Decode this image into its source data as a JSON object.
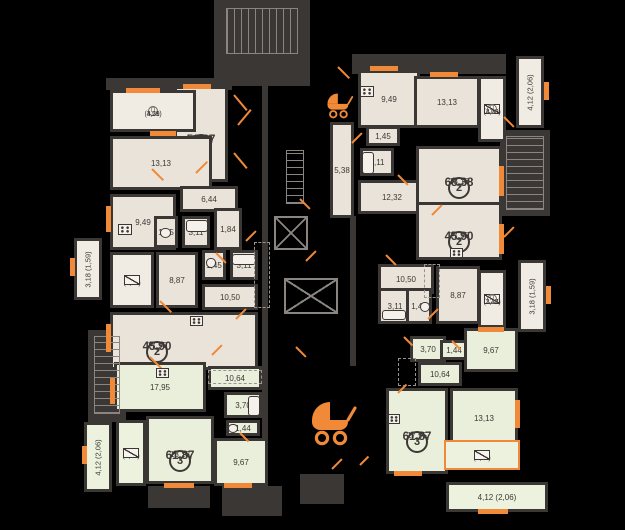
{
  "plan": {
    "colors": {
      "background": "#000000",
      "wall": "#3b3734",
      "room_beige": "#eae3da",
      "room_green": "#e9efda",
      "label_box": "#f0ebe3",
      "accent_orange": "#f08a38",
      "text": "#3c3835",
      "outline_gray": "#8a8580"
    },
    "p_mark": "П",
    "apartment_rooms": [
      {
        "name": "room-living-tl",
        "badge": "2",
        "total": "52,87",
        "area": "14,20",
        "x": 174,
        "y": 86,
        "w": 54,
        "h": 96,
        "fill": "beige"
      },
      {
        "name": "room-bedroom-tl",
        "area": "13,13",
        "x": 110,
        "y": 136,
        "w": 102,
        "h": 54,
        "fill": "beige"
      },
      {
        "name": "room-kitchen-tl",
        "area": "9,49",
        "x": 110,
        "y": 194,
        "w": 66,
        "h": 56,
        "fill": "beige"
      },
      {
        "name": "room-hall-tl",
        "area": "6,44",
        "x": 180,
        "y": 186,
        "w": 58,
        "h": 26,
        "fill": "beige"
      },
      {
        "name": "room-wc-tl",
        "area": "1,45",
        "x": 154,
        "y": 216,
        "w": 24,
        "h": 32,
        "fill": "beige"
      },
      {
        "name": "room-bath-tl",
        "area": "3,11",
        "x": 182,
        "y": 216,
        "w": 28,
        "h": 32,
        "fill": "beige"
      },
      {
        "name": "room-hall2-tl",
        "area": "1,84",
        "x": 214,
        "y": 208,
        "w": 28,
        "h": 42,
        "fill": "beige"
      },
      {
        "name": "room-hall-ml",
        "area": "8,87",
        "x": 156,
        "y": 252,
        "w": 42,
        "h": 56,
        "fill": "beige"
      },
      {
        "name": "room-wc-ml",
        "area": "1,45",
        "x": 202,
        "y": 250,
        "w": 24,
        "h": 30,
        "fill": "beige"
      },
      {
        "name": "room-bath-ml",
        "area": "3,11",
        "x": 230,
        "y": 250,
        "w": 28,
        "h": 30,
        "fill": "beige"
      },
      {
        "name": "room-corridor-ml",
        "area": "10,50",
        "x": 202,
        "y": 284,
        "w": 56,
        "h": 26,
        "fill": "beige"
      },
      {
        "name": "room-living-ml",
        "badge": "2",
        "total": "45,90",
        "area": "17,95",
        "x": 110,
        "y": 312,
        "w": 148,
        "h": 58,
        "fill": "beige",
        "tx": 154,
        "ty": 338
      },
      {
        "name": "room-kitchen-bl",
        "area": "17,95",
        "x": 114,
        "y": 362,
        "w": 92,
        "h": 50,
        "fill": "green"
      },
      {
        "name": "room-corridor-bl",
        "area": "10,64",
        "x": 208,
        "y": 366,
        "w": 54,
        "h": 24,
        "fill": "green"
      },
      {
        "name": "room-bath-bl",
        "area": "3,70",
        "x": 224,
        "y": 392,
        "w": 38,
        "h": 26,
        "fill": "green"
      },
      {
        "name": "room-wc-bl",
        "area": "1,44",
        "x": 226,
        "y": 420,
        "w": 34,
        "h": 16,
        "fill": "green"
      },
      {
        "name": "room-living-bl",
        "badge": "3",
        "total": "61,87",
        "area": "13,13",
        "x": 146,
        "y": 416,
        "w": 68,
        "h": 68,
        "fill": "green"
      },
      {
        "name": "room-bedroom-bl",
        "area": "9,67",
        "x": 214,
        "y": 438,
        "w": 54,
        "h": 48,
        "fill": "green"
      },
      {
        "name": "room-kitchen-tr",
        "area": "9,49",
        "x": 358,
        "y": 70,
        "w": 62,
        "h": 58,
        "fill": "beige"
      },
      {
        "name": "room-bedroom-tr",
        "area": "13,13",
        "x": 414,
        "y": 76,
        "w": 66,
        "h": 52,
        "fill": "beige"
      },
      {
        "name": "room-wc-tr",
        "area": "1,45",
        "x": 366,
        "y": 126,
        "w": 34,
        "h": 20,
        "fill": "beige"
      },
      {
        "name": "room-bath-tr",
        "area": "3,11",
        "x": 360,
        "y": 148,
        "w": 34,
        "h": 28,
        "fill": "beige"
      },
      {
        "name": "room-corridor-tr",
        "area": "5,38",
        "x": 330,
        "y": 122,
        "w": 24,
        "h": 96,
        "fill": "beige"
      },
      {
        "name": "room-hall-tr",
        "area": "12,32",
        "x": 358,
        "y": 180,
        "w": 68,
        "h": 34,
        "fill": "beige"
      },
      {
        "name": "room-living-tr",
        "badge": "2",
        "total": "68,38",
        "area": "18,16",
        "x": 416,
        "y": 146,
        "w": 86,
        "h": 62,
        "fill": "beige"
      },
      {
        "name": "room-living-mr",
        "badge": "2",
        "total": "45,90",
        "area": "17,95",
        "x": 416,
        "y": 202,
        "w": 86,
        "h": 58,
        "fill": "beige"
      },
      {
        "name": "room-corridor-mr",
        "area": "10,50",
        "x": 378,
        "y": 264,
        "w": 56,
        "h": 30,
        "fill": "beige"
      },
      {
        "name": "room-bath-mr",
        "area": "3,11",
        "x": 378,
        "y": 288,
        "w": 34,
        "h": 36,
        "fill": "beige"
      },
      {
        "name": "room-wc-mr",
        "area": "1,45",
        "x": 406,
        "y": 288,
        "w": 26,
        "h": 36,
        "fill": "beige"
      },
      {
        "name": "room-hall-mr",
        "area": "8,87",
        "x": 436,
        "y": 266,
        "w": 44,
        "h": 58,
        "fill": "beige"
      },
      {
        "name": "room-bath-br",
        "area": "3,70",
        "x": 410,
        "y": 336,
        "w": 36,
        "h": 26,
        "fill": "green"
      },
      {
        "name": "room-wc-br",
        "area": "1,44",
        "x": 440,
        "y": 340,
        "w": 28,
        "h": 20,
        "fill": "green"
      },
      {
        "name": "room-bedroom-br",
        "area": "9,67",
        "x": 464,
        "y": 328,
        "w": 54,
        "h": 44,
        "fill": "green"
      },
      {
        "name": "room-corridor-br",
        "area": "10,64",
        "x": 418,
        "y": 362,
        "w": 44,
        "h": 24,
        "fill": "green"
      },
      {
        "name": "room-bedroom2-br",
        "area": "13,13",
        "x": 450,
        "y": 388,
        "w": 68,
        "h": 60,
        "fill": "green"
      },
      {
        "name": "room-living-br",
        "badge": "3",
        "total": "61,87",
        "area": "17,95",
        "x": 386,
        "y": 388,
        "w": 62,
        "h": 86,
        "fill": "green"
      }
    ],
    "balconies": [
      {
        "name": "balcony-tl",
        "lines": [
          "4,59",
          "(3,21)"
        ],
        "x": 110,
        "y": 90,
        "w": 86,
        "h": 42,
        "fill": "label",
        "p": true,
        "p_pos": "left"
      },
      {
        "name": "balcony-ml",
        "lines": [
          "3,47",
          "(2,43)"
        ],
        "x": 110,
        "y": 252,
        "w": 44,
        "h": 56,
        "fill": "label",
        "p": true,
        "p_pos": "top",
        "win": true,
        "win_pos": "bottom"
      },
      {
        "name": "balcony-bl",
        "lines": [
          "4,69",
          "(3,28)"
        ],
        "x": 116,
        "y": 420,
        "w": 30,
        "h": 66,
        "fill": "green_label",
        "p": true,
        "p_pos": "top",
        "win": true,
        "win_pos": "bottom"
      },
      {
        "name": "balcony-tr",
        "lines": [
          "4,69",
          "(3,28)"
        ],
        "x": 478,
        "y": 76,
        "w": 28,
        "h": 66,
        "fill": "label",
        "p": true,
        "p_pos": "bottom",
        "win": true,
        "win_pos": "top"
      },
      {
        "name": "balcony-mr",
        "lines": [
          "3,47",
          "(2,43)"
        ],
        "x": 478,
        "y": 270,
        "w": 28,
        "h": 58,
        "fill": "label",
        "p": true,
        "p_pos": "bottom",
        "win": true,
        "win_pos": "top"
      },
      {
        "name": "balcony-br",
        "lines": [
          "4,69",
          "(3,28)"
        ],
        "x": 444,
        "y": 440,
        "w": 76,
        "h": 30,
        "fill": "green_label",
        "p": true,
        "p_pos": "left",
        "win": true,
        "win_pos": "right",
        "highlight": true
      },
      {
        "name": "balcony-common-left",
        "text": "3,18 (1,59)",
        "x": 74,
        "y": 238,
        "w": 28,
        "h": 62,
        "fill": "label",
        "rotated": true
      },
      {
        "name": "balcony-common-left-bottom",
        "text": "4,12 (2,06)",
        "x": 84,
        "y": 422,
        "w": 28,
        "h": 70,
        "fill": "green_label",
        "rotated": true
      },
      {
        "name": "balcony-common-right-top",
        "text": "4,12 (2,06)",
        "x": 516,
        "y": 56,
        "w": 28,
        "h": 72,
        "fill": "label",
        "rotated": true
      },
      {
        "name": "balcony-common-right",
        "text": "3,18 (1,59)",
        "x": 518,
        "y": 260,
        "w": 28,
        "h": 72,
        "fill": "label",
        "rotated": true
      },
      {
        "name": "balcony-common-bottom",
        "text": "4,12 (2,06)",
        "x": 446,
        "y": 482,
        "w": 102,
        "h": 30,
        "fill": "green_label"
      }
    ],
    "stairs": [
      {
        "name": "staircase-top",
        "x": 226,
        "y": 8,
        "w": 72,
        "h": 46,
        "dir": "v"
      },
      {
        "name": "staircase-left",
        "x": 94,
        "y": 336,
        "w": 26,
        "h": 78,
        "dir": "h"
      },
      {
        "name": "staircase-right",
        "x": 506,
        "y": 136,
        "w": 38,
        "h": 74,
        "dir": "h"
      },
      {
        "name": "staircase-core",
        "x": 286,
        "y": 150,
        "w": 18,
        "h": 54,
        "dir": "h"
      }
    ],
    "elevators": [
      {
        "x": 274,
        "y": 216,
        "w": 34,
        "h": 34
      },
      {
        "x": 284,
        "y": 278,
        "w": 54,
        "h": 36
      }
    ],
    "stubs": [
      {
        "x": 214,
        "y": 0,
        "w": 96,
        "h": 86
      },
      {
        "x": 88,
        "y": 330,
        "w": 38,
        "h": 92
      },
      {
        "x": 500,
        "y": 130,
        "w": 50,
        "h": 86
      },
      {
        "x": 222,
        "y": 486,
        "w": 60,
        "h": 30
      },
      {
        "x": 148,
        "y": 486,
        "w": 62,
        "h": 22
      },
      {
        "x": 300,
        "y": 474,
        "w": 44,
        "h": 30
      },
      {
        "x": 352,
        "y": 54,
        "w": 154,
        "h": 20
      },
      {
        "x": 106,
        "y": 78,
        "w": 126,
        "h": 12
      },
      {
        "x": 262,
        "y": 86,
        "w": 6,
        "h": 404
      },
      {
        "x": 350,
        "y": 216,
        "w": 6,
        "h": 150
      }
    ],
    "windows": [
      {
        "x": 126,
        "y": 88,
        "w": 34,
        "h": 5
      },
      {
        "x": 183,
        "y": 84,
        "w": 28,
        "h": 5
      },
      {
        "x": 150,
        "y": 131,
        "w": 26,
        "h": 5
      },
      {
        "x": 106,
        "y": 206,
        "w": 5,
        "h": 26
      },
      {
        "x": 106,
        "y": 324,
        "w": 5,
        "h": 28
      },
      {
        "x": 110,
        "y": 378,
        "w": 5,
        "h": 26
      },
      {
        "x": 164,
        "y": 483,
        "w": 30,
        "h": 5
      },
      {
        "x": 224,
        "y": 483,
        "w": 28,
        "h": 5
      },
      {
        "x": 370,
        "y": 66,
        "w": 28,
        "h": 5
      },
      {
        "x": 430,
        "y": 72,
        "w": 28,
        "h": 5
      },
      {
        "x": 499,
        "y": 166,
        "w": 5,
        "h": 30
      },
      {
        "x": 499,
        "y": 224,
        "w": 5,
        "h": 30
      },
      {
        "x": 515,
        "y": 400,
        "w": 5,
        "h": 28
      },
      {
        "x": 478,
        "y": 327,
        "w": 26,
        "h": 5
      },
      {
        "x": 394,
        "y": 471,
        "w": 28,
        "h": 5
      },
      {
        "x": 478,
        "y": 509,
        "w": 30,
        "h": 5
      },
      {
        "x": 70,
        "y": 258,
        "w": 5,
        "h": 18
      },
      {
        "x": 82,
        "y": 446,
        "w": 5,
        "h": 18
      },
      {
        "x": 544,
        "y": 82,
        "w": 5,
        "h": 18
      },
      {
        "x": 546,
        "y": 286,
        "w": 5,
        "h": 18
      }
    ],
    "door_marks": [
      {
        "x": 234,
        "y": 94,
        "len": 20,
        "deg": 50
      },
      {
        "x": 238,
        "y": 124,
        "len": 20,
        "deg": -50
      },
      {
        "x": 234,
        "y": 152,
        "len": 20,
        "deg": 50
      },
      {
        "x": 152,
        "y": 168,
        "len": 16,
        "deg": 45
      },
      {
        "x": 196,
        "y": 172,
        "len": 16,
        "deg": -45
      },
      {
        "x": 216,
        "y": 252,
        "len": 14,
        "deg": 45
      },
      {
        "x": 246,
        "y": 240,
        "len": 14,
        "deg": -45
      },
      {
        "x": 160,
        "y": 300,
        "len": 16,
        "deg": 45
      },
      {
        "x": 236,
        "y": 318,
        "len": 14,
        "deg": -45
      },
      {
        "x": 150,
        "y": 356,
        "len": 16,
        "deg": 45
      },
      {
        "x": 212,
        "y": 354,
        "len": 14,
        "deg": -45
      },
      {
        "x": 240,
        "y": 432,
        "len": 12,
        "deg": 45
      },
      {
        "x": 338,
        "y": 66,
        "len": 16,
        "deg": 45
      },
      {
        "x": 352,
        "y": 142,
        "len": 14,
        "deg": -45
      },
      {
        "x": 398,
        "y": 174,
        "len": 14,
        "deg": 45
      },
      {
        "x": 432,
        "y": 214,
        "len": 14,
        "deg": -45
      },
      {
        "x": 386,
        "y": 254,
        "len": 14,
        "deg": 45
      },
      {
        "x": 428,
        "y": 318,
        "len": 14,
        "deg": -45
      },
      {
        "x": 404,
        "y": 336,
        "len": 12,
        "deg": 45
      },
      {
        "x": 398,
        "y": 392,
        "len": 12,
        "deg": -45
      },
      {
        "x": 300,
        "y": 198,
        "len": 14,
        "deg": 45
      },
      {
        "x": 306,
        "y": 260,
        "len": 14,
        "deg": -45
      },
      {
        "x": 296,
        "y": 346,
        "len": 14,
        "deg": 45
      },
      {
        "x": 332,
        "y": 468,
        "len": 14,
        "deg": -45
      },
      {
        "x": 452,
        "y": 340,
        "len": 12,
        "deg": 45
      },
      {
        "x": 360,
        "y": 464,
        "len": 12,
        "deg": -45
      },
      {
        "x": 504,
        "y": 116,
        "len": 14,
        "deg": 45
      },
      {
        "x": 504,
        "y": 236,
        "len": 14,
        "deg": -45
      }
    ],
    "fixtures": [
      {
        "t": "stove",
        "x": 118,
        "y": 224,
        "w": 14,
        "h": 11
      },
      {
        "t": "stove",
        "x": 190,
        "y": 316,
        "w": 13,
        "h": 10
      },
      {
        "t": "stove",
        "x": 156,
        "y": 368,
        "w": 13,
        "h": 10
      },
      {
        "t": "stove",
        "x": 360,
        "y": 86,
        "w": 14,
        "h": 11
      },
      {
        "t": "stove",
        "x": 450,
        "y": 248,
        "w": 13,
        "h": 10
      },
      {
        "t": "stove",
        "x": 388,
        "y": 414,
        "w": 12,
        "h": 10
      },
      {
        "t": "tub",
        "x": 186,
        "y": 220,
        "w": 22,
        "h": 12
      },
      {
        "t": "tub",
        "x": 232,
        "y": 254,
        "w": 24,
        "h": 11
      },
      {
        "t": "tub",
        "x": 362,
        "y": 152,
        "w": 12,
        "h": 22
      },
      {
        "t": "tub",
        "x": 382,
        "y": 310,
        "w": 24,
        "h": 10
      },
      {
        "t": "tub",
        "x": 248,
        "y": 396,
        "w": 12,
        "h": 20
      },
      {
        "t": "wc",
        "x": 160,
        "y": 228,
        "w": 11,
        "h": 10
      },
      {
        "t": "wc",
        "x": 206,
        "y": 258,
        "w": 10,
        "h": 10
      },
      {
        "t": "wc",
        "x": 420,
        "y": 302,
        "w": 10,
        "h": 10
      },
      {
        "t": "wc",
        "x": 228,
        "y": 424,
        "w": 10,
        "h": 9
      }
    ],
    "dashed_zones": [
      {
        "x": 208,
        "y": 370,
        "w": 54,
        "h": 14
      },
      {
        "x": 398,
        "y": 358,
        "w": 18,
        "h": 28
      },
      {
        "x": 424,
        "y": 264,
        "w": 16,
        "h": 34
      },
      {
        "x": 254,
        "y": 242,
        "w": 16,
        "h": 66
      }
    ],
    "icons": [
      {
        "name": "stroller-icon",
        "x": 306,
        "y": 396,
        "size": 52
      },
      {
        "name": "stroller-icon-small",
        "x": 324,
        "y": 90,
        "size": 30
      }
    ]
  }
}
